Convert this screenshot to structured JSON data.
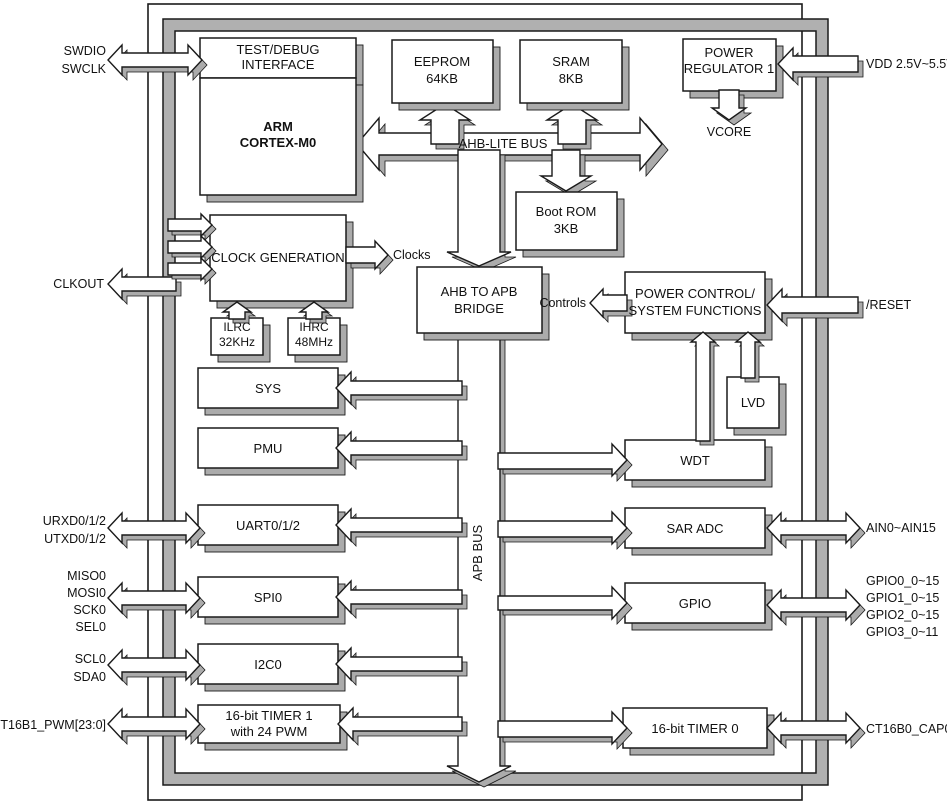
{
  "blocks": {
    "test_debug": {
      "l1": "TEST/DEBUG",
      "l2": "INTERFACE"
    },
    "arm": {
      "l1": "ARM",
      "l2": "CORTEX-M0"
    },
    "eeprom": {
      "l1": "EEPROM",
      "l2": "64KB"
    },
    "sram": {
      "l1": "SRAM",
      "l2": "8KB"
    },
    "power_regulator": {
      "l1": "POWER",
      "l2": "REGULATOR 1"
    },
    "boot_rom": {
      "l1": "Boot ROM",
      "l2": "3KB"
    },
    "clock_generation": {
      "l1": "CLOCK GENERATION"
    },
    "ilrc": {
      "l1": "ILRC",
      "l2": "32KHz"
    },
    "ihrc": {
      "l1": "IHRC",
      "l2": "48MHz"
    },
    "ahb_apb_bridge": {
      "l1": "AHB TO APB",
      "l2": "BRIDGE"
    },
    "power_control": {
      "l1": "POWER CONTROL/",
      "l2": "SYSTEM FUNCTIONS"
    },
    "lvd": {
      "l1": "LVD"
    },
    "sys": {
      "l1": "SYS"
    },
    "pmu": {
      "l1": "PMU"
    },
    "uart": {
      "l1": "UART0/1/2"
    },
    "spi": {
      "l1": "SPI0"
    },
    "i2c": {
      "l1": "I2C0"
    },
    "timer1": {
      "l1": "16-bit TIMER 1",
      "l2": "with 24 PWM"
    },
    "wdt": {
      "l1": "WDT"
    },
    "sar_adc": {
      "l1": "SAR ADC"
    },
    "gpio": {
      "l1": "GPIO"
    },
    "timer0": {
      "l1": "16-bit TIMER 0"
    }
  },
  "buses": {
    "ahb": "AHB-LITE BUS",
    "apb": "APB BUS"
  },
  "annotations": {
    "clocks": "Clocks",
    "controls": "Controls",
    "vcore": "VCORE"
  },
  "pins": {
    "left": {
      "swdio": "SWDIO",
      "swclk": "SWCLK",
      "clkout": "CLKOUT",
      "urxd": "URXD0/1/2",
      "utxd": "UTXD0/1/2",
      "miso": "MISO0",
      "mosi": "MOSI0",
      "sck": "SCK0",
      "sel": "SEL0",
      "scl": "SCL0",
      "sda": "SDA0",
      "ct16b1": "CT16B1_PWM[23:0]"
    },
    "right": {
      "vdd": "VDD 2.5V~5.5V",
      "reset": "/RESET",
      "ain": "AIN0~AIN15",
      "gpio0": "GPIO0_0~15",
      "gpio1": "GPIO1_0~15",
      "gpio2": "GPIO2_0~15",
      "gpio3": "GPIO3_0~11",
      "ct16b0": "CT16B0_CAP0"
    }
  },
  "colors": {
    "line": "#1a1a1a",
    "shadow": "#ababab",
    "fill": "#ffffff"
  }
}
